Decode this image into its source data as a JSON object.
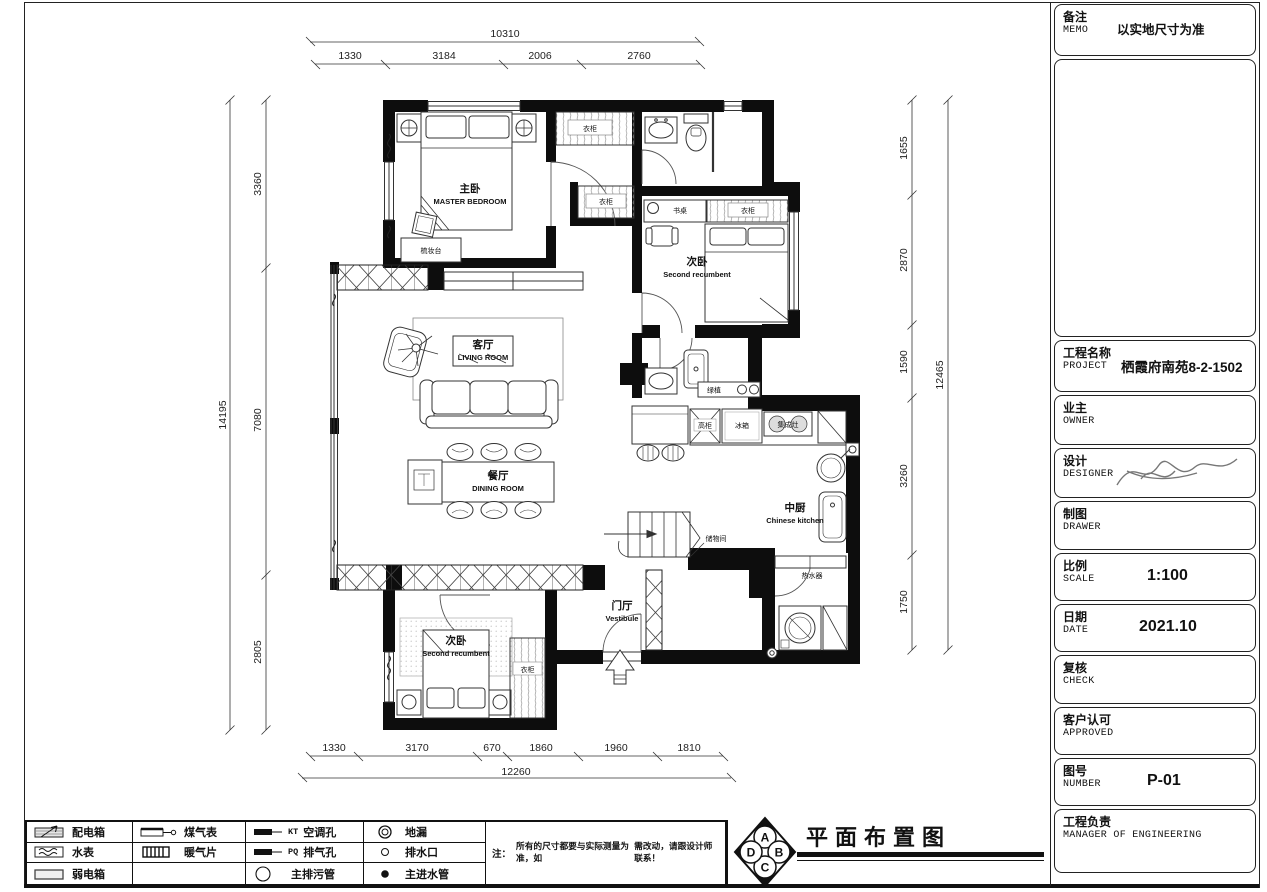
{
  "drawing_title": "平面布置图",
  "compass": {
    "top": "A",
    "right": "B",
    "bottom": "C",
    "left": "D"
  },
  "title_block": {
    "memo": {
      "cn": "备注",
      "en": "MEMO",
      "value": "以实地尺寸为准"
    },
    "project": {
      "cn": "工程名称",
      "en": "PROJECT",
      "value": "栖霞府南苑8-2-1502"
    },
    "owner": {
      "cn": "业主",
      "en": "OWNER"
    },
    "designer": {
      "cn": "设计",
      "en": "DESIGNER"
    },
    "drawer": {
      "cn": "制图",
      "en": "DRAWER"
    },
    "scale": {
      "cn": "比例",
      "en": "SCALE",
      "value": "1:100"
    },
    "date": {
      "cn": "日期",
      "en": "DATE",
      "value": "2021.10"
    },
    "check": {
      "cn": "复核",
      "en": "CHECK"
    },
    "approved": {
      "cn": "客户认可",
      "en": "APPROVED"
    },
    "number": {
      "cn": "图号",
      "en": "NUMBER",
      "value": "P-01"
    },
    "manager": {
      "cn": "工程负责",
      "en": "MANAGER OF ENGINEERING"
    }
  },
  "legend": {
    "items": [
      {
        "icon": "distribution-box",
        "label": "配电箱"
      },
      {
        "icon": "water-meter",
        "label": "水表"
      },
      {
        "icon": "weak-current-box",
        "label": "弱电箱"
      },
      {
        "icon": "gas-meter",
        "label": "煤气表"
      },
      {
        "icon": "radiator",
        "label": "暖气片"
      },
      {
        "icon": "ac-hole",
        "label": "空调孔",
        "tag": "KT"
      },
      {
        "icon": "exhaust-hole",
        "label": "排气孔",
        "tag": "PQ"
      },
      {
        "icon": "main-sewage-pipe",
        "label": "主排污管"
      },
      {
        "icon": "floor-drain",
        "label": "地漏"
      },
      {
        "icon": "drain-outlet",
        "label": "排水口"
      },
      {
        "icon": "main-water-inlet",
        "label": "主进水管"
      }
    ],
    "note": {
      "head": "注：",
      "line1": "所有的尺寸都要与实际测量为准，如",
      "line2": "需改动，请跟设计师联系！"
    }
  },
  "rooms": {
    "master": {
      "cn": "主卧",
      "en": "MASTER BEDROOM"
    },
    "bedroom2": {
      "cn": "次卧",
      "en": "Second recumbent"
    },
    "bedroom3": {
      "cn": "次卧",
      "en": "Second recumbent"
    },
    "living": {
      "cn": "客厅",
      "en": "LIVING ROOM"
    },
    "dining": {
      "cn": "餐厅",
      "en": "DINING ROOM"
    },
    "kitchen": {
      "cn": "中厨",
      "en": "Chinese kitchen"
    },
    "vestibule": {
      "cn": "门厅",
      "en": "Vestibule"
    }
  },
  "fixtures": {
    "wardrobe": "衣柜",
    "desk": "书桌",
    "dresser": "梳妆台",
    "tall_cabinet": "高柜",
    "fridge": "冰箱",
    "stove": "集成灶",
    "plant": "绿植",
    "water_heater": "热水器",
    "storage": "储物间"
  },
  "dimensions": {
    "top": {
      "overall": "10310",
      "segments": [
        "1330",
        "3184",
        "2006",
        "2760"
      ]
    },
    "bottom": {
      "overall": "12260",
      "segments": [
        "1330",
        "3170",
        "670",
        "1860",
        "1960",
        "1810"
      ]
    },
    "left": {
      "overall": "14195",
      "segments": [
        "3360",
        "7080",
        "2805"
      ]
    },
    "right": {
      "overall": "12465",
      "segments": [
        "1655",
        "2870",
        "1590",
        "3260",
        "1750"
      ]
    }
  }
}
